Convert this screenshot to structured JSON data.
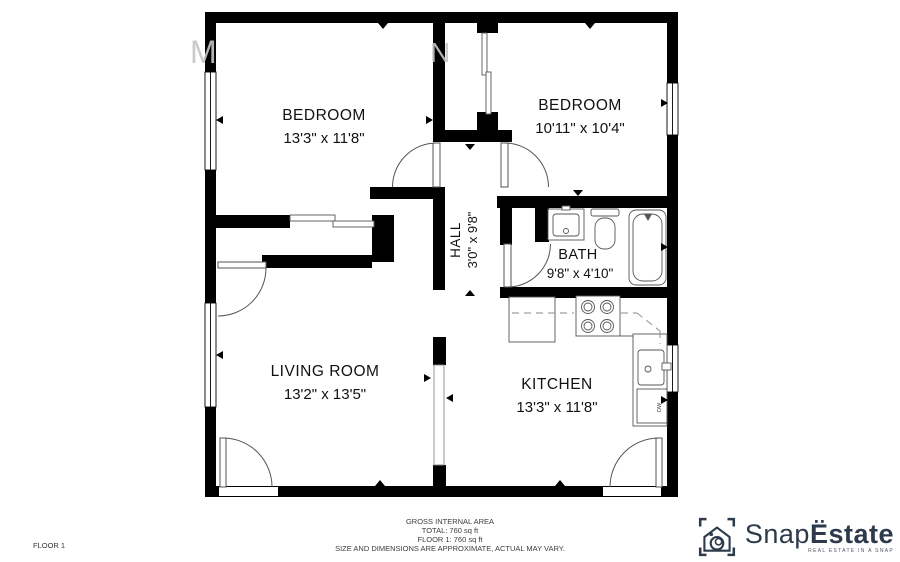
{
  "watermark": {
    "letters": [
      "M",
      "N"
    ]
  },
  "rooms": [
    {
      "name": "BEDROOM",
      "dims": "13'3\" x 11'8\""
    },
    {
      "name": "BEDROOM",
      "dims": "10'11\" x 10'4\""
    },
    {
      "name": "HALL",
      "dims": "3'0\" x 9'8\""
    },
    {
      "name": "BATH",
      "dims": "9'8\" x 4'10\""
    },
    {
      "name": "LIVING ROOM",
      "dims": "13'2\" x 13'5\""
    },
    {
      "name": "KITCHEN",
      "dims": "13'3\" x 11'8\""
    }
  ],
  "fixtures": {
    "dishwasher_label": "DW"
  },
  "footer": {
    "floor_label": "FLOOR 1",
    "area_title": "GROSS INTERNAL AREA",
    "total_line": "TOTAL: 760 sq ft",
    "floor_line": "FLOOR 1: 760 sq ft",
    "disclaimer": "SIZE AND DIMENSIONS ARE APPROXIMATE, ACTUAL MAY VARY."
  },
  "logo": {
    "brand_primary": "Snap",
    "brand_secondary": "Ëstate",
    "tagline": "REAL ESTATE IN A SNAP"
  },
  "colors": {
    "wall": "#000000",
    "fixture_line": "#555555",
    "logo_navy": "#2d3a4c",
    "watermark": "#c6c6c6"
  }
}
